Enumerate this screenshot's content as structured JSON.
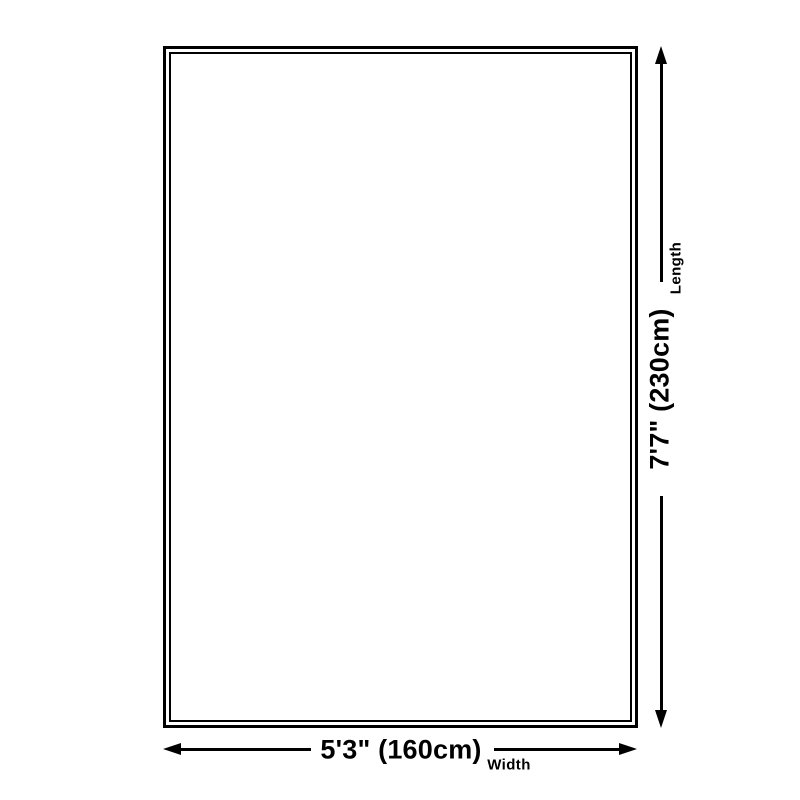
{
  "theme": {
    "line_color": "#000000",
    "background_color": "#ffffff"
  },
  "diagram": {
    "length": {
      "value": "7'7\" (230cm)",
      "label": "Length"
    },
    "width": {
      "value": "5'3\" (160cm)",
      "label": "Width"
    },
    "icons": {
      "vertical_arrow": "double-headed-arrow-vertical",
      "horizontal_arrow": "double-headed-arrow-horizontal"
    }
  }
}
